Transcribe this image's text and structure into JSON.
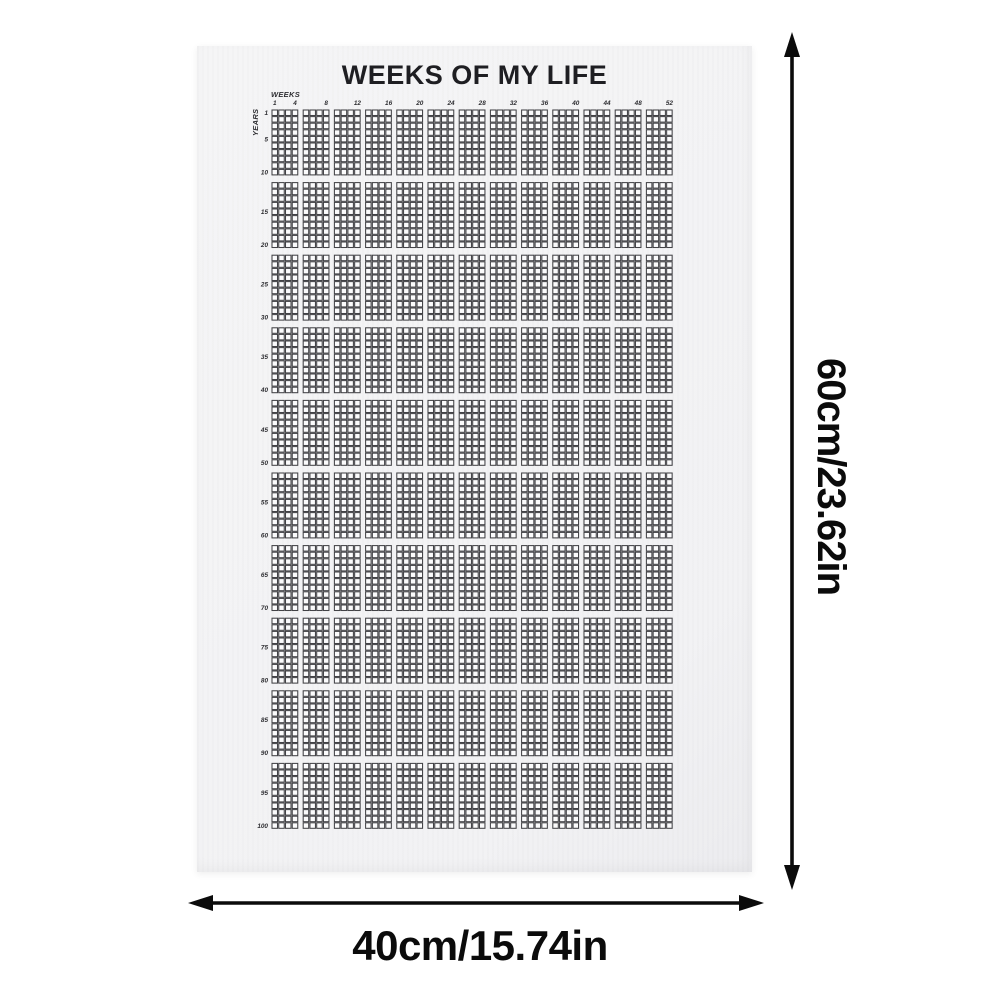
{
  "poster": {
    "title": "WEEKS OF MY LIFE",
    "weeks_axis_label": "WEEKS",
    "years_axis_label": "YEARS",
    "week_ticks": [
      1,
      4,
      8,
      12,
      16,
      20,
      24,
      28,
      32,
      36,
      40,
      44,
      48,
      52
    ],
    "year_ticks": [
      1,
      5,
      10,
      15,
      20,
      25,
      30,
      35,
      40,
      45,
      50,
      55,
      60,
      65,
      70,
      75,
      80,
      85,
      90,
      95,
      100
    ],
    "grid": {
      "weeks_per_year": 52,
      "total_years": 100,
      "week_group_size": 4,
      "year_group_size": 10,
      "cells_filled": 0
    },
    "colors": {
      "paper": "#f5f5f6",
      "cell_stroke": "#424246",
      "cell_fill": "#fbfbfc",
      "title_text": "#1e1e22",
      "tick_text": "#2e2e32"
    }
  },
  "dimensions": {
    "height_label": "60cm/23.62in",
    "width_label": "40cm/15.74in",
    "arrow_color": "#0b0b0b"
  }
}
